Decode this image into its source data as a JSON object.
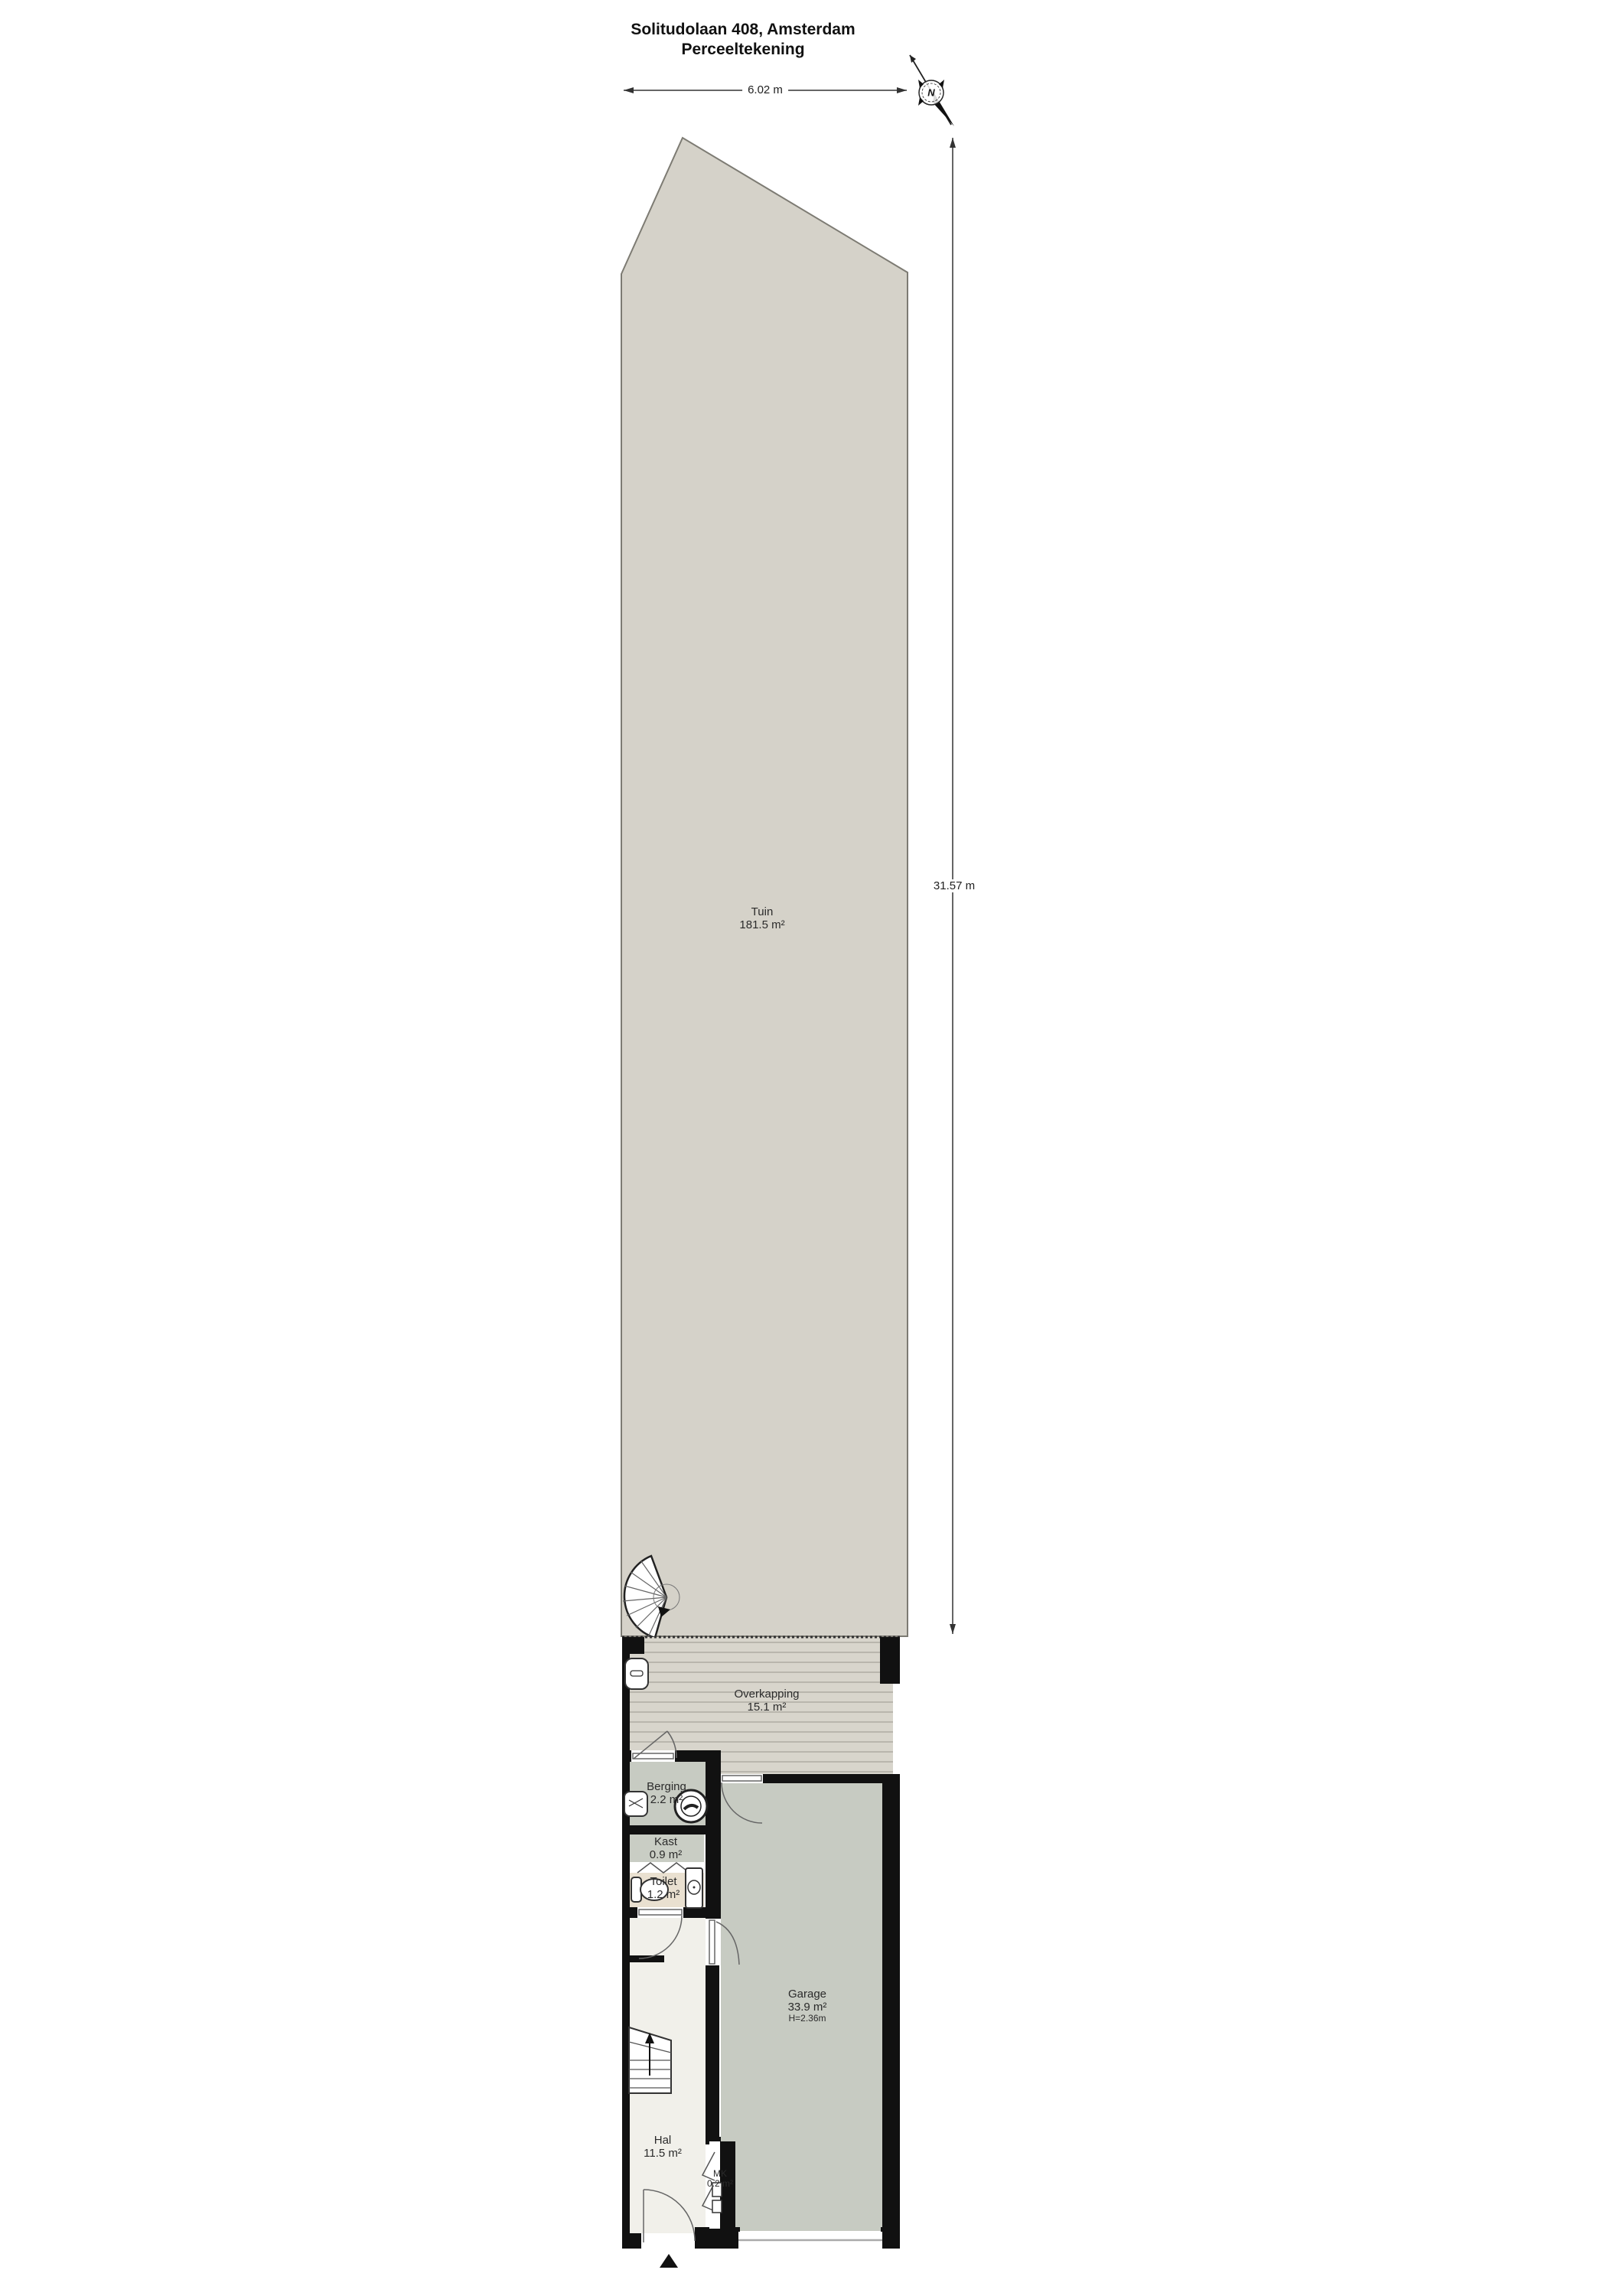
{
  "title": {
    "line1": "Solitudolaan 408, Amsterdam",
    "line2": "Perceeltekening"
  },
  "dimensions": {
    "width": "6.02 m",
    "depth": "31.57 m"
  },
  "compass": {
    "label": "N"
  },
  "rooms": {
    "tuin": {
      "name": "Tuin",
      "area": "181.5 m²"
    },
    "overkapping": {
      "name": "Overkapping",
      "area": "15.1 m²"
    },
    "berging": {
      "name": "Berging",
      "area": "2.2 m²"
    },
    "kast": {
      "name": "Kast",
      "area": "0.9 m²"
    },
    "toilet": {
      "name": "Toilet",
      "area": "1.2 m²"
    },
    "garage": {
      "name": "Garage",
      "area": "33.9 m²",
      "height": "H=2.36m"
    },
    "hal": {
      "name": "Hal",
      "area": "11.5 m²"
    },
    "mk": {
      "name": "MK",
      "area": "0.2 m²"
    }
  },
  "colors": {
    "wall": "#111111",
    "garden": "#d5d2c9",
    "deck": "#d8d5cc",
    "deck_line": "#b9b6ad",
    "garage_floor": "#c7cbc2",
    "toilet_floor": "#e9e0d0",
    "hal_floor": "#f1f0ea",
    "outline": "#7d7b73"
  }
}
